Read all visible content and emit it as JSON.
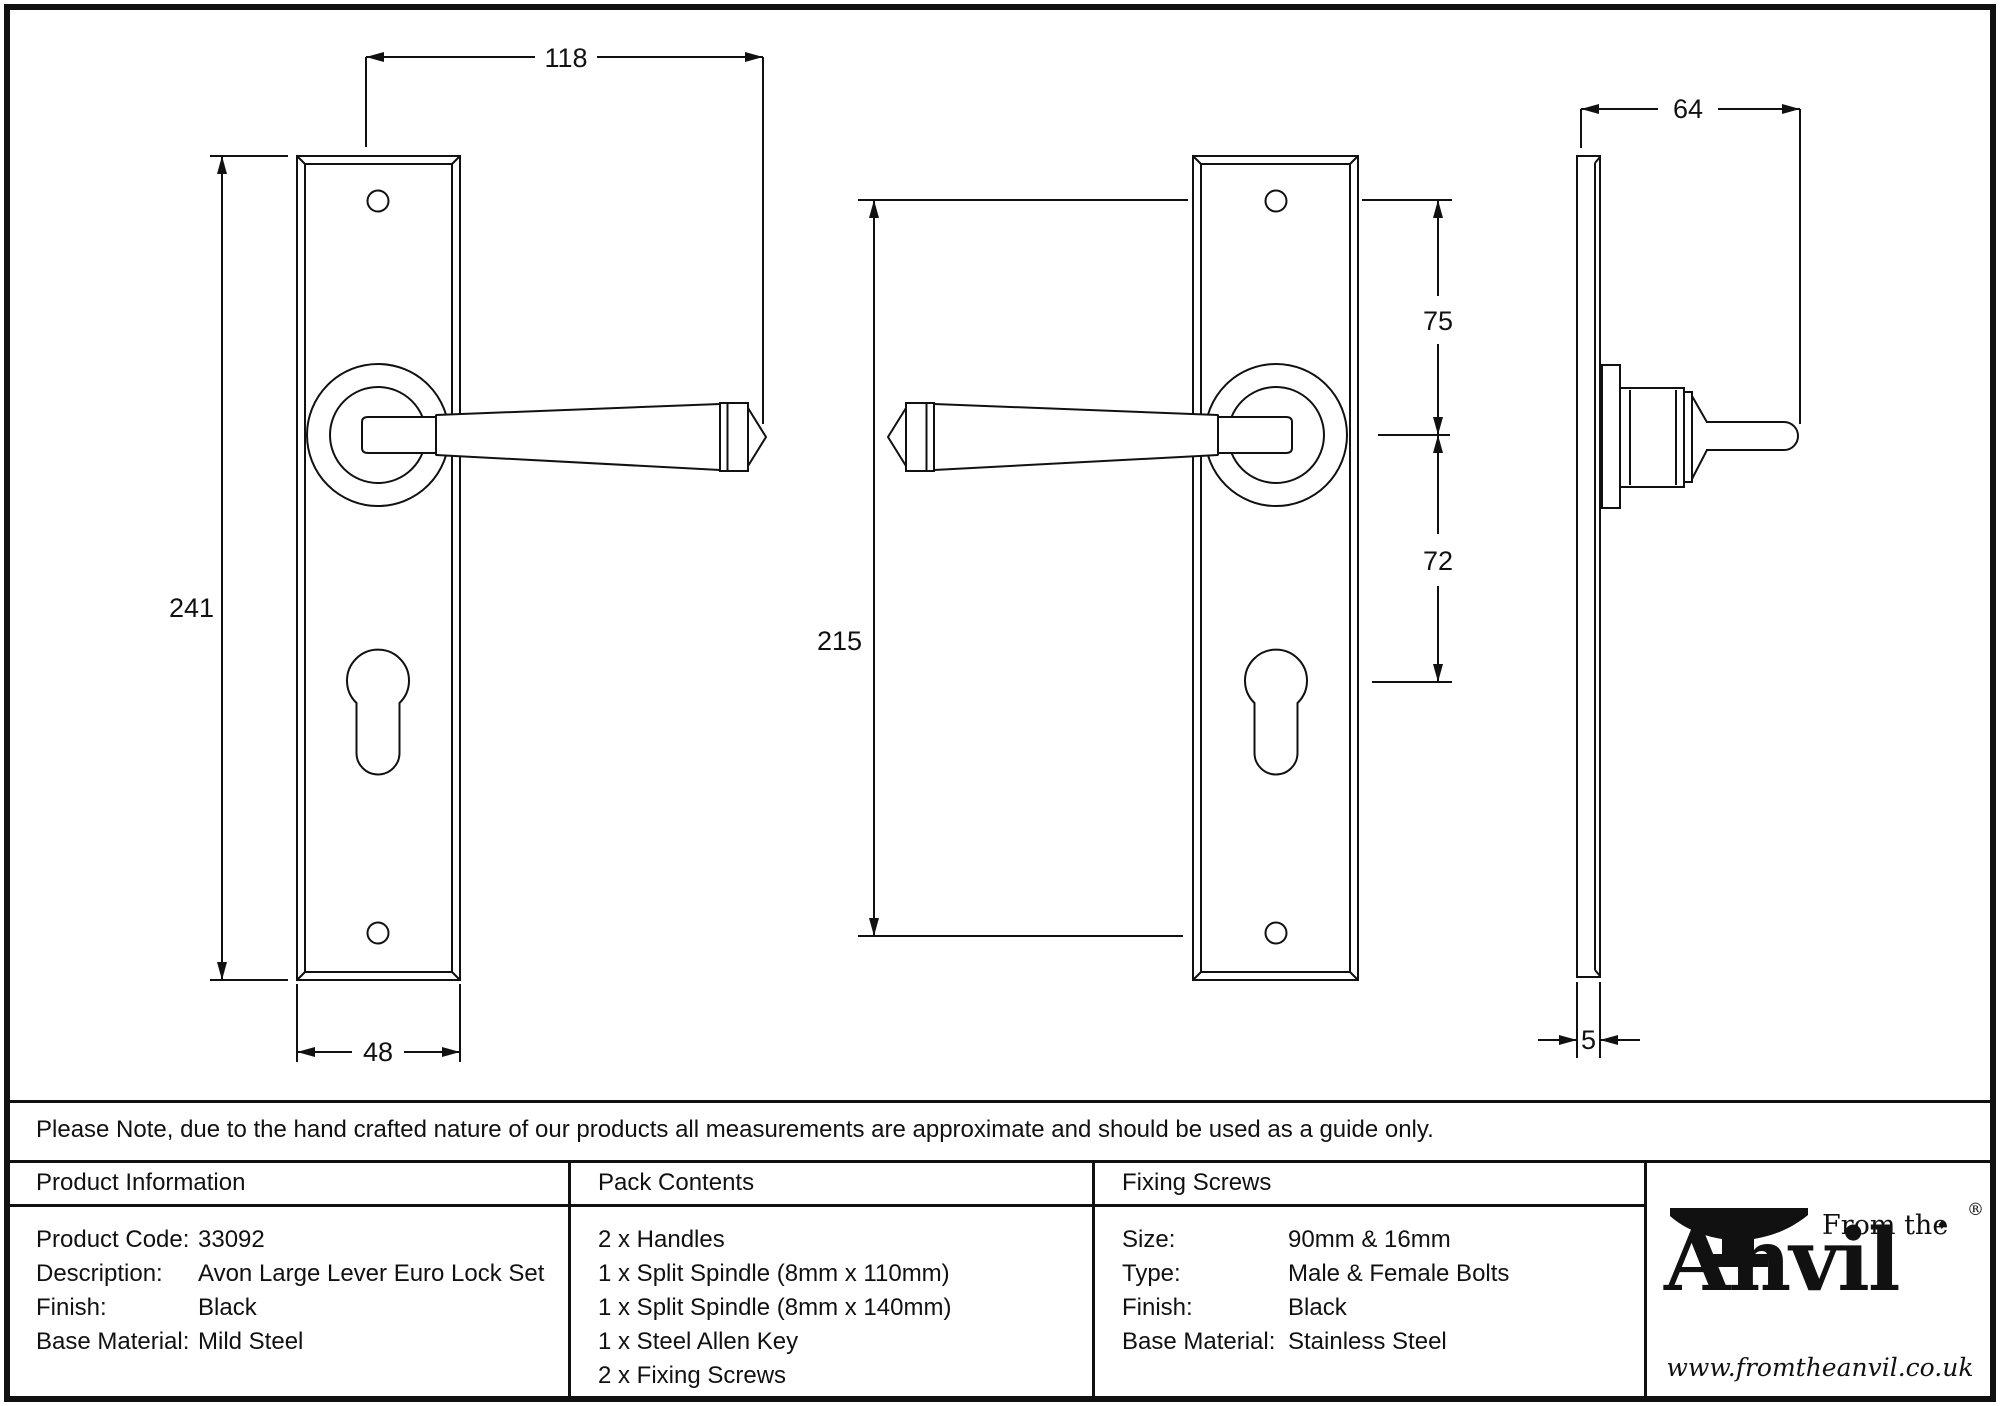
{
  "drawings": {
    "front_view_right": {
      "dim_handle_length": "118",
      "dim_plate_height": "241",
      "dim_plate_width": "48"
    },
    "front_view_left": {
      "dim_screw_centres": "215",
      "dim_screw_to_spindle": "75",
      "dim_spindle_to_keyhole": "72"
    },
    "side_view": {
      "dim_projection": "64",
      "dim_plate_thickness": "5"
    }
  },
  "note_bar": {
    "text": "Please Note, due to the hand crafted nature of our products all measurements are approximate and should be used as a guide only."
  },
  "product_information": {
    "title": "Product Information",
    "rows": [
      {
        "label": "Product Code:",
        "value": "33092"
      },
      {
        "label": "Description:",
        "value": "Avon Large Lever Euro Lock Set"
      },
      {
        "label": "Finish:",
        "value": "Black"
      },
      {
        "label": "Base Material:",
        "value": "Mild Steel"
      }
    ]
  },
  "pack_contents": {
    "title": "Pack Contents",
    "items": [
      "2 x Handles",
      "1 x Split Spindle (8mm x 110mm)",
      "1 x Split Spindle (8mm x 140mm)",
      "1 x Steel Allen Key",
      "2 x Fixing Screws"
    ]
  },
  "fixing_screws": {
    "title": "Fixing Screws",
    "rows": [
      {
        "label": "Size:",
        "value": "90mm & 16mm"
      },
      {
        "label": "Type:",
        "value": "Male & Female Bolts"
      },
      {
        "label": "Finish:",
        "value": "Black"
      },
      {
        "label": "Base Material:",
        "value": "Stainless Steel"
      }
    ]
  },
  "logo": {
    "from_the": "From the",
    "diamond": "♦",
    "name": "Anvil",
    "registered": "®",
    "url": "www.fromtheanvil.co.uk"
  }
}
